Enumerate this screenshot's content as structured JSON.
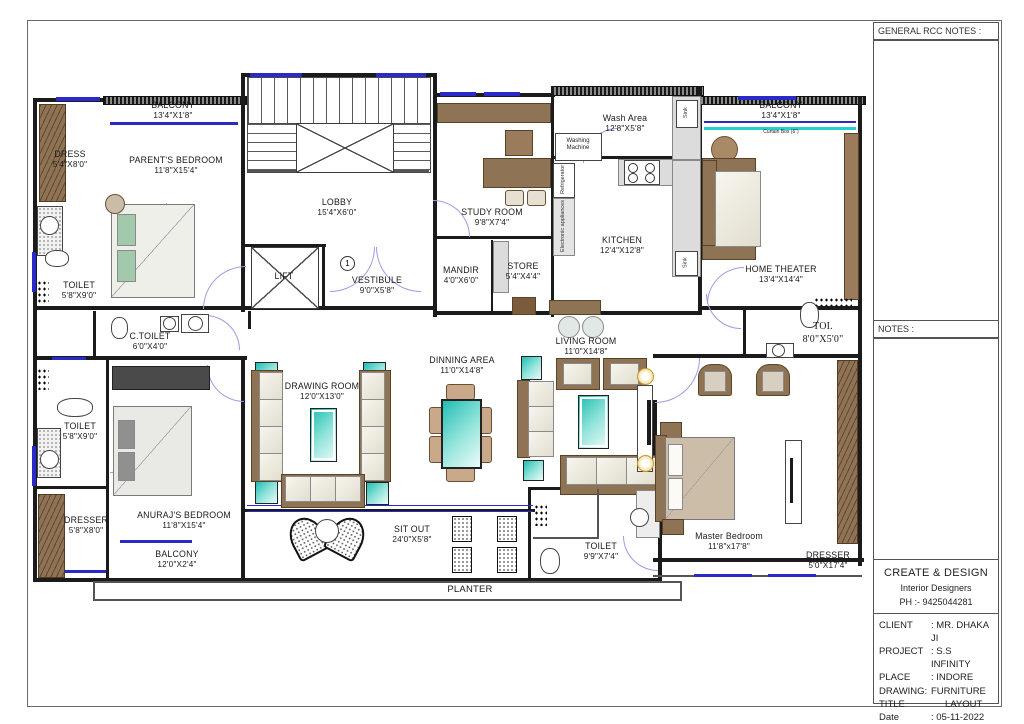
{
  "colors": {
    "accent_teal": "#2EC9BE",
    "furniture_brown": "#8F7355",
    "wall": "#1B1B1B",
    "window_blue": "#2A2AC8",
    "door_arc": "#9A9CE2",
    "curtain_cyan": "#25CFCF",
    "gold": "#C79A28"
  },
  "rooms": {
    "balcony_tl": {
      "name": "BALCONY",
      "dims": "13'4\"X1'8\""
    },
    "dress": {
      "name": "DRESS",
      "dims": "5'4\"X8'0\""
    },
    "parents_bedroom": {
      "name": "PARENT'S BEDROOM",
      "dims": "11'8\"X15'4\""
    },
    "toilet_tl": {
      "name": "TOILET",
      "dims": "5'8\"X9'0\""
    },
    "lobby": {
      "name": "LOBBY",
      "dims": "15'4\"X6'0\""
    },
    "lift": {
      "name": "LIFT"
    },
    "vestibule": {
      "name": "VESTIBULE",
      "dims": "9'0\"X5'8\"",
      "marker": "1"
    },
    "study_room": {
      "name": "STUDY ROOM",
      "dims": "9'8\"X7'4\""
    },
    "mandir": {
      "name": "MANDIR",
      "dims": "4'0\"X6'0\""
    },
    "store": {
      "name": "STORE",
      "dims": "5'4\"X4'4\""
    },
    "wash_area": {
      "name": "Wash Area",
      "dims": "12'8\"X5'8\""
    },
    "kitchen": {
      "name": "KITCHEN",
      "dims": "12'4\"X12'8\""
    },
    "balcony_tr": {
      "name": "BALCONY",
      "dims": "13'4\"X1'8\""
    },
    "curtain_box": {
      "name": "Curtain Box (6\")"
    },
    "home_theater": {
      "name": "HOME THEATER",
      "dims": "13'4\"X14'4\""
    },
    "c_toilet": {
      "name": "C.TOILET",
      "dims": "6'0\"X4'0\""
    },
    "living_room": {
      "name": "LIVING ROOM",
      "dims": "11'0\"X14'8\""
    },
    "dinning_area": {
      "name": "DINNING AREA",
      "dims": "11'0\"X14'8\""
    },
    "drawing_room": {
      "name": "DRAWING ROOM",
      "dims": "12'0\"X13'0\""
    },
    "toi": {
      "name": "TOI.",
      "dims": "8'0\"X5'0\""
    },
    "toilet_ml": {
      "name": "TOILET",
      "dims": "5'8\"X9'0\""
    },
    "anurajs_bedroom": {
      "name": "ANURAJ'S BEDROOM",
      "dims": "11'8\"X15'4\""
    },
    "dresser_l": {
      "name": "DRESSER",
      "dims": "5'8\"X8'0\""
    },
    "balcony_bl": {
      "name": "BALCONY",
      "dims": "12'0\"X2'4\""
    },
    "sit_out": {
      "name": "SIT OUT",
      "dims": "24'0\"X5'8\""
    },
    "toilet_b": {
      "name": "TOILET",
      "dims": "9'9\"X7'4\""
    },
    "master_bedroom": {
      "name": "Master Bedroom",
      "dims": "11'8\"x17'8\""
    },
    "dresser_r": {
      "name": "DRESSER",
      "dims": "5'0\"X17'4\""
    },
    "planter": {
      "name": "PLANTER"
    }
  },
  "appliances": {
    "washing_machine": "Washing Machine",
    "refrigerator": "Refrigerator",
    "electronic_appliances": "Electronic appliances",
    "sink_top": "Sink",
    "sink_bottom": "Sink"
  },
  "title_block": {
    "general_notes_heading": "GENERAL RCC NOTES :",
    "notes_heading": "NOTES :",
    "firm": {
      "name": "CREATE & DESIGN",
      "subtitle": "Interior Designers",
      "phone": "PH :- 9425044281"
    },
    "info": [
      {
        "label": "CLIENT",
        "value": ": MR. DHAKA JI"
      },
      {
        "label": "PROJECT",
        "value": ": S.S INFINITY"
      },
      {
        "label": "PLACE",
        "value": ": INDORE"
      },
      {
        "label": "DRAWING:",
        "value": "FURNITURE"
      },
      {
        "label": "TITLE",
        "value": "LAYOUT"
      },
      {
        "label": "Date",
        "value": ": 05-11-2022"
      }
    ]
  }
}
